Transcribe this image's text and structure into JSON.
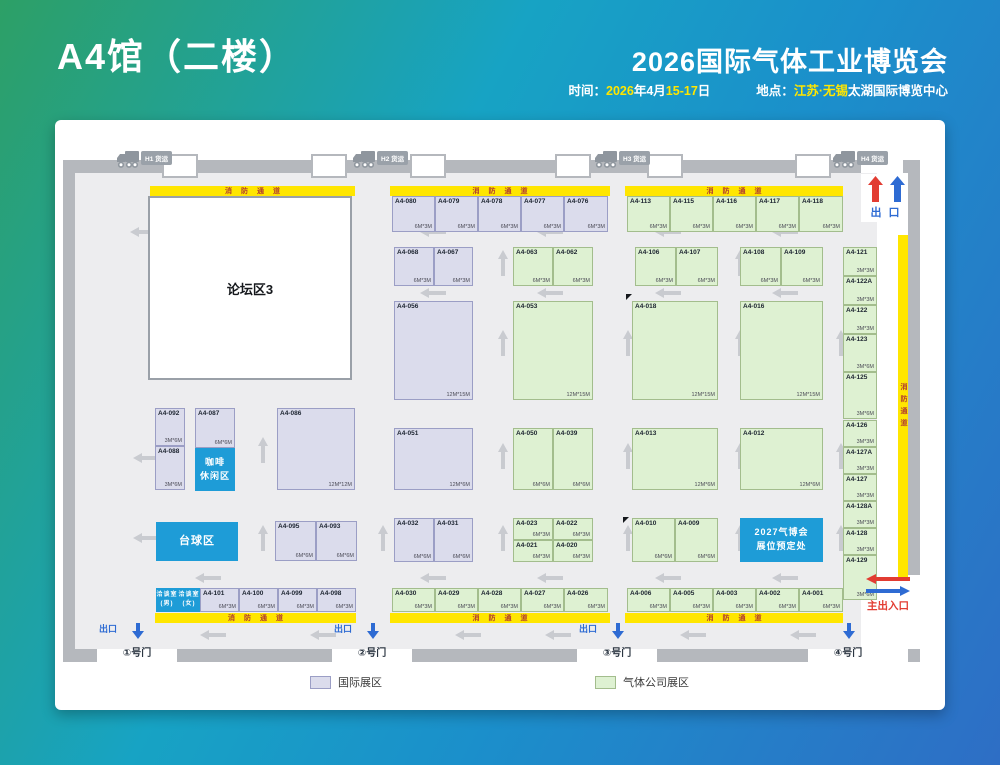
{
  "header": {
    "hall_title": "A4馆（二楼）",
    "expo_title": "2026国际气体工业博览会",
    "time_label": "时间：",
    "time_parts": [
      [
        "2026",
        "y"
      ],
      [
        "年4月",
        "w"
      ],
      [
        "15-17",
        "y"
      ],
      [
        "日",
        "w"
      ]
    ],
    "loc_label": "地点：",
    "loc_parts": [
      [
        "江苏·无锡",
        "y"
      ],
      [
        "太湖国际博览中心",
        "w"
      ]
    ]
  },
  "colors": {
    "intl_fill": "#dbdcec",
    "intl_border": "#9b9ec5",
    "gas_fill": "#def1d2",
    "gas_border": "#a3bd8d",
    "lane_yellow": "#ffe600",
    "lane_text": "#b03a30",
    "wall": "#b5b8bd",
    "floor": "#ededef",
    "blue_box": "#1e9cd7",
    "exit_red": "#e23c32",
    "exit_blue": "#2e6bd3",
    "arrow": "#c9cbd0"
  },
  "legend": [
    {
      "label": "国际展区",
      "type": "intl"
    },
    {
      "label": "气体公司展区",
      "type": "gas"
    }
  ],
  "exits": {
    "top_exit": "出 口",
    "main_entrance": "主出入口"
  },
  "plan": {
    "forum_label": "论坛区3",
    "fire_lane_text": "消防通道",
    "fire_lanes": [
      {
        "x": 95,
        "y": 66,
        "w": 205,
        "h": 10
      },
      {
        "x": 335,
        "y": 66,
        "w": 220,
        "h": 10
      },
      {
        "x": 570,
        "y": 66,
        "w": 218,
        "h": 10
      },
      {
        "x": 100,
        "y": 493,
        "w": 201,
        "h": 10
      },
      {
        "x": 335,
        "y": 493,
        "w": 220,
        "h": 10
      },
      {
        "x": 570,
        "y": 493,
        "w": 218,
        "h": 10
      }
    ],
    "fire_lane_vertical": {
      "x": 843,
      "y": 115,
      "w": 10,
      "h": 343
    },
    "trucks": [
      {
        "label": "H1 货运",
        "x": 62,
        "y": 30
      },
      {
        "label": "H2 货运",
        "x": 298,
        "y": 30
      },
      {
        "label": "H3 货运",
        "x": 540,
        "y": 30
      },
      {
        "label": "H4 货运",
        "x": 778,
        "y": 30
      }
    ],
    "gates": [
      {
        "label": "①号门",
        "exit": "出口",
        "cx": 82
      },
      {
        "label": "②号门",
        "exit": "出口",
        "cx": 317
      },
      {
        "label": "③号门",
        "exit": "出口",
        "cx": 562
      },
      {
        "label": "④号门",
        "cx": 793
      }
    ],
    "areas": [
      {
        "name": "coffee-lounge",
        "lines": [
          "咖啡",
          "休闲区"
        ],
        "x": 140,
        "y": 328,
        "w": 40,
        "h": 43,
        "fs": 9
      },
      {
        "name": "billiards-area",
        "lines": [
          "台球区"
        ],
        "x": 101,
        "y": 402,
        "w": 82,
        "h": 39,
        "fs": 11
      },
      {
        "name": "2027-booth-reservation",
        "lines": [
          "2027气博会",
          "展位预定处"
        ],
        "x": 685,
        "y": 398,
        "w": 83,
        "h": 44,
        "fs": 9
      },
      {
        "name": "meeting-room-male",
        "lines": [
          "洽谈室",
          "(男)"
        ],
        "x": 101,
        "y": 468,
        "w": 22,
        "h": 24,
        "fs": 6
      },
      {
        "name": "meeting-room-female",
        "lines": [
          "洽谈室",
          "(女)"
        ],
        "x": 123,
        "y": 468,
        "w": 22,
        "h": 24,
        "fs": 6
      }
    ],
    "booths": [
      {
        "id": "A4-080",
        "x": 337,
        "y": 76,
        "w": 43,
        "h": 36,
        "t": "intl",
        "s": "6M*3M"
      },
      {
        "id": "A4-079",
        "x": 380,
        "y": 76,
        "w": 43,
        "h": 36,
        "t": "intl",
        "s": "6M*3M"
      },
      {
        "id": "A4-078",
        "x": 423,
        "y": 76,
        "w": 43,
        "h": 36,
        "t": "intl",
        "s": "6M*3M"
      },
      {
        "id": "A4-077",
        "x": 466,
        "y": 76,
        "w": 43,
        "h": 36,
        "t": "intl",
        "s": "6M*3M"
      },
      {
        "id": "A4-076",
        "x": 509,
        "y": 76,
        "w": 44,
        "h": 36,
        "t": "intl",
        "s": "6M*3M"
      },
      {
        "id": "A4-113",
        "x": 572,
        "y": 76,
        "w": 43,
        "h": 36,
        "t": "gas",
        "s": "6M*3M"
      },
      {
        "id": "A4-115",
        "x": 615,
        "y": 76,
        "w": 43,
        "h": 36,
        "t": "gas",
        "s": "6M*3M"
      },
      {
        "id": "A4-116",
        "x": 658,
        "y": 76,
        "w": 43,
        "h": 36,
        "t": "gas",
        "s": "6M*3M"
      },
      {
        "id": "A4-117",
        "x": 701,
        "y": 76,
        "w": 43,
        "h": 36,
        "t": "gas",
        "s": "6M*3M"
      },
      {
        "id": "A4-118",
        "x": 744,
        "y": 76,
        "w": 44,
        "h": 36,
        "t": "gas",
        "s": "6M*3M"
      },
      {
        "id": "A4-068",
        "x": 339,
        "y": 127,
        "w": 40,
        "h": 39,
        "t": "intl",
        "s": "6M*3M"
      },
      {
        "id": "A4-067",
        "x": 379,
        "y": 127,
        "w": 39,
        "h": 39,
        "t": "intl",
        "s": "6M*3M"
      },
      {
        "id": "A4-063",
        "x": 458,
        "y": 127,
        "w": 40,
        "h": 39,
        "t": "gas",
        "s": "6M*3M"
      },
      {
        "id": "A4-062",
        "x": 498,
        "y": 127,
        "w": 40,
        "h": 39,
        "t": "gas",
        "s": "6M*3M"
      },
      {
        "id": "A4-106",
        "x": 580,
        "y": 127,
        "w": 41,
        "h": 39,
        "t": "gas",
        "s": "6M*3M"
      },
      {
        "id": "A4-107",
        "x": 621,
        "y": 127,
        "w": 42,
        "h": 39,
        "t": "gas",
        "s": "6M*3M"
      },
      {
        "id": "A4-108",
        "x": 685,
        "y": 127,
        "w": 41,
        "h": 39,
        "t": "gas",
        "s": "6M*3M"
      },
      {
        "id": "A4-109",
        "x": 726,
        "y": 127,
        "w": 42,
        "h": 39,
        "t": "gas",
        "s": "6M*3M"
      },
      {
        "id": "A4-056",
        "x": 339,
        "y": 181,
        "w": 79,
        "h": 99,
        "t": "intl",
        "s": "12M*15M"
      },
      {
        "id": "A4-053",
        "x": 458,
        "y": 181,
        "w": 80,
        "h": 99,
        "t": "gas",
        "s": "12M*15M"
      },
      {
        "id": "A4-018",
        "x": 577,
        "y": 181,
        "w": 86,
        "h": 99,
        "t": "gas",
        "s": "12M*15M"
      },
      {
        "id": "A4-016",
        "x": 685,
        "y": 181,
        "w": 83,
        "h": 99,
        "t": "gas",
        "s": "12M*15M"
      },
      {
        "id": "A4-092",
        "x": 100,
        "y": 288,
        "w": 30,
        "h": 38,
        "t": "intl",
        "s": "3M*6M"
      },
      {
        "id": "A4-088",
        "x": 100,
        "y": 326,
        "w": 30,
        "h": 44,
        "t": "intl",
        "s": "3M*6M"
      },
      {
        "id": "A4-087",
        "x": 140,
        "y": 288,
        "w": 40,
        "h": 40,
        "t": "intl",
        "s": "6M*6M"
      },
      {
        "id": "A4-086",
        "x": 222,
        "y": 288,
        "w": 78,
        "h": 82,
        "t": "intl",
        "s": "12M*12M"
      },
      {
        "id": "A4-051",
        "x": 339,
        "y": 308,
        "w": 79,
        "h": 62,
        "t": "intl",
        "s": "12M*6M"
      },
      {
        "id": "A4-050",
        "x": 458,
        "y": 308,
        "w": 40,
        "h": 62,
        "t": "gas",
        "s": "6M*6M"
      },
      {
        "id": "A4-039",
        "x": 498,
        "y": 308,
        "w": 40,
        "h": 62,
        "t": "gas",
        "s": "6M*6M"
      },
      {
        "id": "A4-013",
        "x": 577,
        "y": 308,
        "w": 86,
        "h": 62,
        "t": "gas",
        "s": "12M*6M"
      },
      {
        "id": "A4-012",
        "x": 685,
        "y": 308,
        "w": 83,
        "h": 62,
        "t": "gas",
        "s": "12M*6M"
      },
      {
        "id": "A4-095",
        "x": 220,
        "y": 401,
        "w": 41,
        "h": 40,
        "t": "intl",
        "s": "6M*6M"
      },
      {
        "id": "A4-093",
        "x": 261,
        "y": 401,
        "w": 41,
        "h": 40,
        "t": "intl",
        "s": "6M*6M"
      },
      {
        "id": "A4-032",
        "x": 339,
        "y": 398,
        "w": 40,
        "h": 44,
        "t": "intl",
        "s": "6M*6M"
      },
      {
        "id": "A4-031",
        "x": 379,
        "y": 398,
        "w": 39,
        "h": 44,
        "t": "intl",
        "s": "6M*6M"
      },
      {
        "id": "A4-023",
        "x": 458,
        "y": 398,
        "w": 40,
        "h": 22,
        "t": "gas",
        "s": "6M*3M"
      },
      {
        "id": "A4-022",
        "x": 498,
        "y": 398,
        "w": 40,
        "h": 22,
        "t": "gas",
        "s": "6M*3M"
      },
      {
        "id": "A4-021",
        "x": 458,
        "y": 420,
        "w": 40,
        "h": 22,
        "t": "gas",
        "s": "6M*3M"
      },
      {
        "id": "A4-020",
        "x": 498,
        "y": 420,
        "w": 40,
        "h": 22,
        "t": "gas",
        "s": "6M*3M"
      },
      {
        "id": "A4-010",
        "x": 577,
        "y": 398,
        "w": 43,
        "h": 44,
        "t": "gas",
        "s": "6M*6M"
      },
      {
        "id": "A4-009",
        "x": 620,
        "y": 398,
        "w": 43,
        "h": 44,
        "t": "gas",
        "s": "6M*6M"
      },
      {
        "id": "A4-121",
        "x": 788,
        "y": 127,
        "w": 34,
        "h": 29,
        "t": "gas",
        "s": "3M*3M"
      },
      {
        "id": "A4-122A",
        "x": 788,
        "y": 156,
        "w": 34,
        "h": 29,
        "t": "gas",
        "s": "3M*3M"
      },
      {
        "id": "A4-122",
        "x": 788,
        "y": 185,
        "w": 34,
        "h": 29,
        "t": "gas",
        "s": "3M*3M"
      },
      {
        "id": "A4-123",
        "x": 788,
        "y": 214,
        "w": 34,
        "h": 38,
        "t": "gas",
        "s": "3M*6M"
      },
      {
        "id": "A4-125",
        "x": 788,
        "y": 252,
        "w": 34,
        "h": 47,
        "t": "gas",
        "s": "3M*6M"
      },
      {
        "id": "A4-126",
        "x": 788,
        "y": 300,
        "w": 34,
        "h": 27,
        "t": "gas",
        "s": "3M*3M"
      },
      {
        "id": "A4-127A",
        "x": 788,
        "y": 327,
        "w": 34,
        "h": 27,
        "t": "gas",
        "s": "3M*3M"
      },
      {
        "id": "A4-127",
        "x": 788,
        "y": 354,
        "w": 34,
        "h": 27,
        "t": "gas",
        "s": "3M*3M"
      },
      {
        "id": "A4-128A",
        "x": 788,
        "y": 381,
        "w": 34,
        "h": 27,
        "t": "gas",
        "s": "3M*3M"
      },
      {
        "id": "A4-128",
        "x": 788,
        "y": 408,
        "w": 34,
        "h": 27,
        "t": "gas",
        "s": "3M*3M"
      },
      {
        "id": "A4-129",
        "x": 788,
        "y": 435,
        "w": 34,
        "h": 45,
        "t": "gas",
        "s": "3M*6M"
      },
      {
        "id": "A4-101",
        "x": 145,
        "y": 468,
        "w": 39,
        "h": 24,
        "t": "intl",
        "s": "6M*3M"
      },
      {
        "id": "A4-100",
        "x": 184,
        "y": 468,
        "w": 39,
        "h": 24,
        "t": "intl",
        "s": "6M*3M"
      },
      {
        "id": "A4-099",
        "x": 223,
        "y": 468,
        "w": 39,
        "h": 24,
        "t": "intl",
        "s": "6M*3M"
      },
      {
        "id": "A4-098",
        "x": 262,
        "y": 468,
        "w": 39,
        "h": 24,
        "t": "intl",
        "s": "6M*3M"
      },
      {
        "id": "A4-030",
        "x": 337,
        "y": 468,
        "w": 43,
        "h": 24,
        "t": "gas",
        "s": "6M*3M"
      },
      {
        "id": "A4-029",
        "x": 380,
        "y": 468,
        "w": 43,
        "h": 24,
        "t": "gas",
        "s": "6M*3M"
      },
      {
        "id": "A4-028",
        "x": 423,
        "y": 468,
        "w": 43,
        "h": 24,
        "t": "gas",
        "s": "6M*3M"
      },
      {
        "id": "A4-027",
        "x": 466,
        "y": 468,
        "w": 43,
        "h": 24,
        "t": "gas",
        "s": "6M*3M"
      },
      {
        "id": "A4-026",
        "x": 509,
        "y": 468,
        "w": 44,
        "h": 24,
        "t": "gas",
        "s": "6M*3M"
      },
      {
        "id": "A4-006",
        "x": 572,
        "y": 468,
        "w": 43,
        "h": 24,
        "t": "gas",
        "s": "6M*3M"
      },
      {
        "id": "A4-005",
        "x": 615,
        "y": 468,
        "w": 43,
        "h": 24,
        "t": "gas",
        "s": "6M*3M"
      },
      {
        "id": "A4-003",
        "x": 658,
        "y": 468,
        "w": 43,
        "h": 24,
        "t": "gas",
        "s": "6M*3M"
      },
      {
        "id": "A4-002",
        "x": 701,
        "y": 468,
        "w": 43,
        "h": 24,
        "t": "gas",
        "s": "6M*3M"
      },
      {
        "id": "A4-001",
        "x": 744,
        "y": 468,
        "w": 44,
        "h": 24,
        "t": "gas",
        "s": "6M*3M"
      }
    ],
    "flow_arrows": [
      {
        "x": 75,
        "y": 104,
        "d": "left"
      },
      {
        "x": 365,
        "y": 104,
        "d": "left"
      },
      {
        "x": 482,
        "y": 104,
        "d": "left"
      },
      {
        "x": 600,
        "y": 104,
        "d": "left"
      },
      {
        "x": 717,
        "y": 104,
        "d": "left"
      },
      {
        "x": 365,
        "y": 165,
        "d": "left"
      },
      {
        "x": 482,
        "y": 165,
        "d": "left"
      },
      {
        "x": 600,
        "y": 165,
        "d": "left"
      },
      {
        "x": 717,
        "y": 165,
        "d": "left"
      },
      {
        "x": 78,
        "y": 330,
        "d": "left"
      },
      {
        "x": 78,
        "y": 410,
        "d": "left"
      },
      {
        "x": 140,
        "y": 450,
        "d": "left"
      },
      {
        "x": 365,
        "y": 450,
        "d": "left"
      },
      {
        "x": 482,
        "y": 450,
        "d": "left"
      },
      {
        "x": 600,
        "y": 450,
        "d": "left"
      },
      {
        "x": 717,
        "y": 450,
        "d": "left"
      },
      {
        "x": 145,
        "y": 507,
        "d": "left"
      },
      {
        "x": 255,
        "y": 507,
        "d": "left"
      },
      {
        "x": 400,
        "y": 507,
        "d": "left"
      },
      {
        "x": 490,
        "y": 507,
        "d": "left"
      },
      {
        "x": 625,
        "y": 507,
        "d": "left"
      },
      {
        "x": 735,
        "y": 507,
        "d": "left"
      },
      {
        "x": 435,
        "y": 135,
        "d": "up"
      },
      {
        "x": 672,
        "y": 135,
        "d": "up"
      },
      {
        "x": 435,
        "y": 215,
        "d": "up"
      },
      {
        "x": 560,
        "y": 215,
        "d": "up"
      },
      {
        "x": 672,
        "y": 215,
        "d": "up"
      },
      {
        "x": 773,
        "y": 215,
        "d": "up"
      },
      {
        "x": 195,
        "y": 322,
        "d": "up"
      },
      {
        "x": 435,
        "y": 328,
        "d": "up"
      },
      {
        "x": 560,
        "y": 328,
        "d": "up"
      },
      {
        "x": 672,
        "y": 328,
        "d": "up"
      },
      {
        "x": 773,
        "y": 328,
        "d": "up"
      },
      {
        "x": 195,
        "y": 410,
        "d": "up"
      },
      {
        "x": 315,
        "y": 410,
        "d": "up"
      },
      {
        "x": 435,
        "y": 410,
        "d": "up"
      },
      {
        "x": 560,
        "y": 410,
        "d": "up"
      },
      {
        "x": 672,
        "y": 410,
        "d": "up"
      },
      {
        "x": 773,
        "y": 410,
        "d": "up"
      }
    ],
    "ticks": [
      {
        "x": 94,
        "y": 77
      },
      {
        "x": 291,
        "y": 176
      },
      {
        "x": 94,
        "y": 252
      },
      {
        "x": 571,
        "y": 174
      },
      {
        "x": 568,
        "y": 397
      }
    ]
  }
}
